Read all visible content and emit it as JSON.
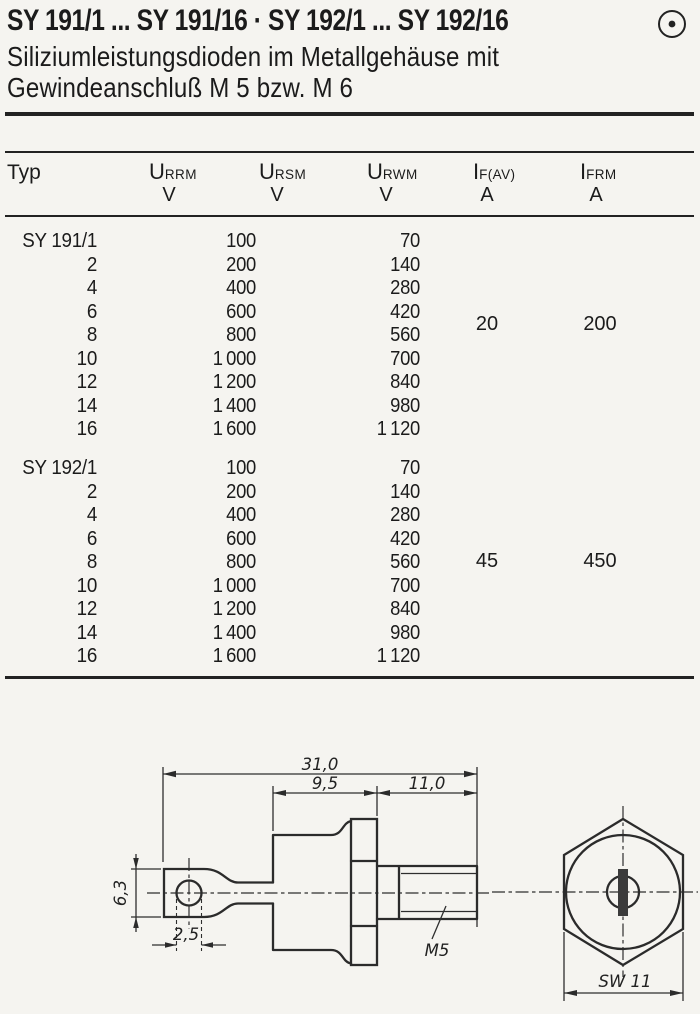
{
  "header": {
    "title": "SY 191/1 ... SY 191/16 · SY 192/1 ... SY 192/16",
    "subtitle_line1": "Siliziumleistungsdioden im Metallgehäuse mit",
    "subtitle_line2": "Gewindeanschluß M 5 bzw. M 6",
    "brand_symbol": "circled-dot"
  },
  "table": {
    "columns": [
      {
        "label": "Typ"
      },
      {
        "sym": "U",
        "sub": "RRM",
        "unit": "V"
      },
      {
        "sym": "U",
        "sub": "RSM",
        "unit": "V"
      },
      {
        "sym": "U",
        "sub": "RWM",
        "unit": "V"
      },
      {
        "sym": "I",
        "sub": "F(AV)",
        "unit": "A"
      },
      {
        "sym": "I",
        "sub": "FRM",
        "unit": "A"
      }
    ],
    "groups": [
      {
        "name": "SY 191",
        "if_av": "20",
        "ifrm": "200",
        "rows": [
          {
            "typ": "SY 191/1",
            "urrm": "100",
            "urwm": "70"
          },
          {
            "typ": "2",
            "urrm": "200",
            "urwm": "140"
          },
          {
            "typ": "4",
            "urrm": "400",
            "urwm": "280"
          },
          {
            "typ": "6",
            "urrm": "600",
            "urwm": "420"
          },
          {
            "typ": "8",
            "urrm": "800",
            "urwm": "560"
          },
          {
            "typ": "10",
            "urrm": "1 000",
            "urwm": "700"
          },
          {
            "typ": "12",
            "urrm": "1 200",
            "urwm": "840"
          },
          {
            "typ": "14",
            "urrm": "1 400",
            "urwm": "980"
          },
          {
            "typ": "16",
            "urrm": "1 600",
            "urwm": "1 120"
          }
        ]
      },
      {
        "name": "SY 192",
        "if_av": "45",
        "ifrm": "450",
        "rows": [
          {
            "typ": "SY 192/1",
            "urrm": "100",
            "urwm": "70"
          },
          {
            "typ": "2",
            "urrm": "200",
            "urwm": "140"
          },
          {
            "typ": "4",
            "urrm": "400",
            "urwm": "280"
          },
          {
            "typ": "6",
            "urrm": "600",
            "urwm": "420"
          },
          {
            "typ": "8",
            "urrm": "800",
            "urwm": "560"
          },
          {
            "typ": "10",
            "urrm": "1 000",
            "urwm": "700"
          },
          {
            "typ": "12",
            "urrm": "1 200",
            "urwm": "840"
          },
          {
            "typ": "14",
            "urrm": "1 400",
            "urwm": "980"
          },
          {
            "typ": "16",
            "urrm": "1 600",
            "urwm": "1 120"
          }
        ]
      }
    ]
  },
  "drawing": {
    "dim_overall": "31,0",
    "dim_body": "9,5",
    "dim_stud": "11,0",
    "dim_lug_height": "6,3",
    "dim_hole": "2,5",
    "thread_label": "M5",
    "wrench_label": "SW 11"
  }
}
